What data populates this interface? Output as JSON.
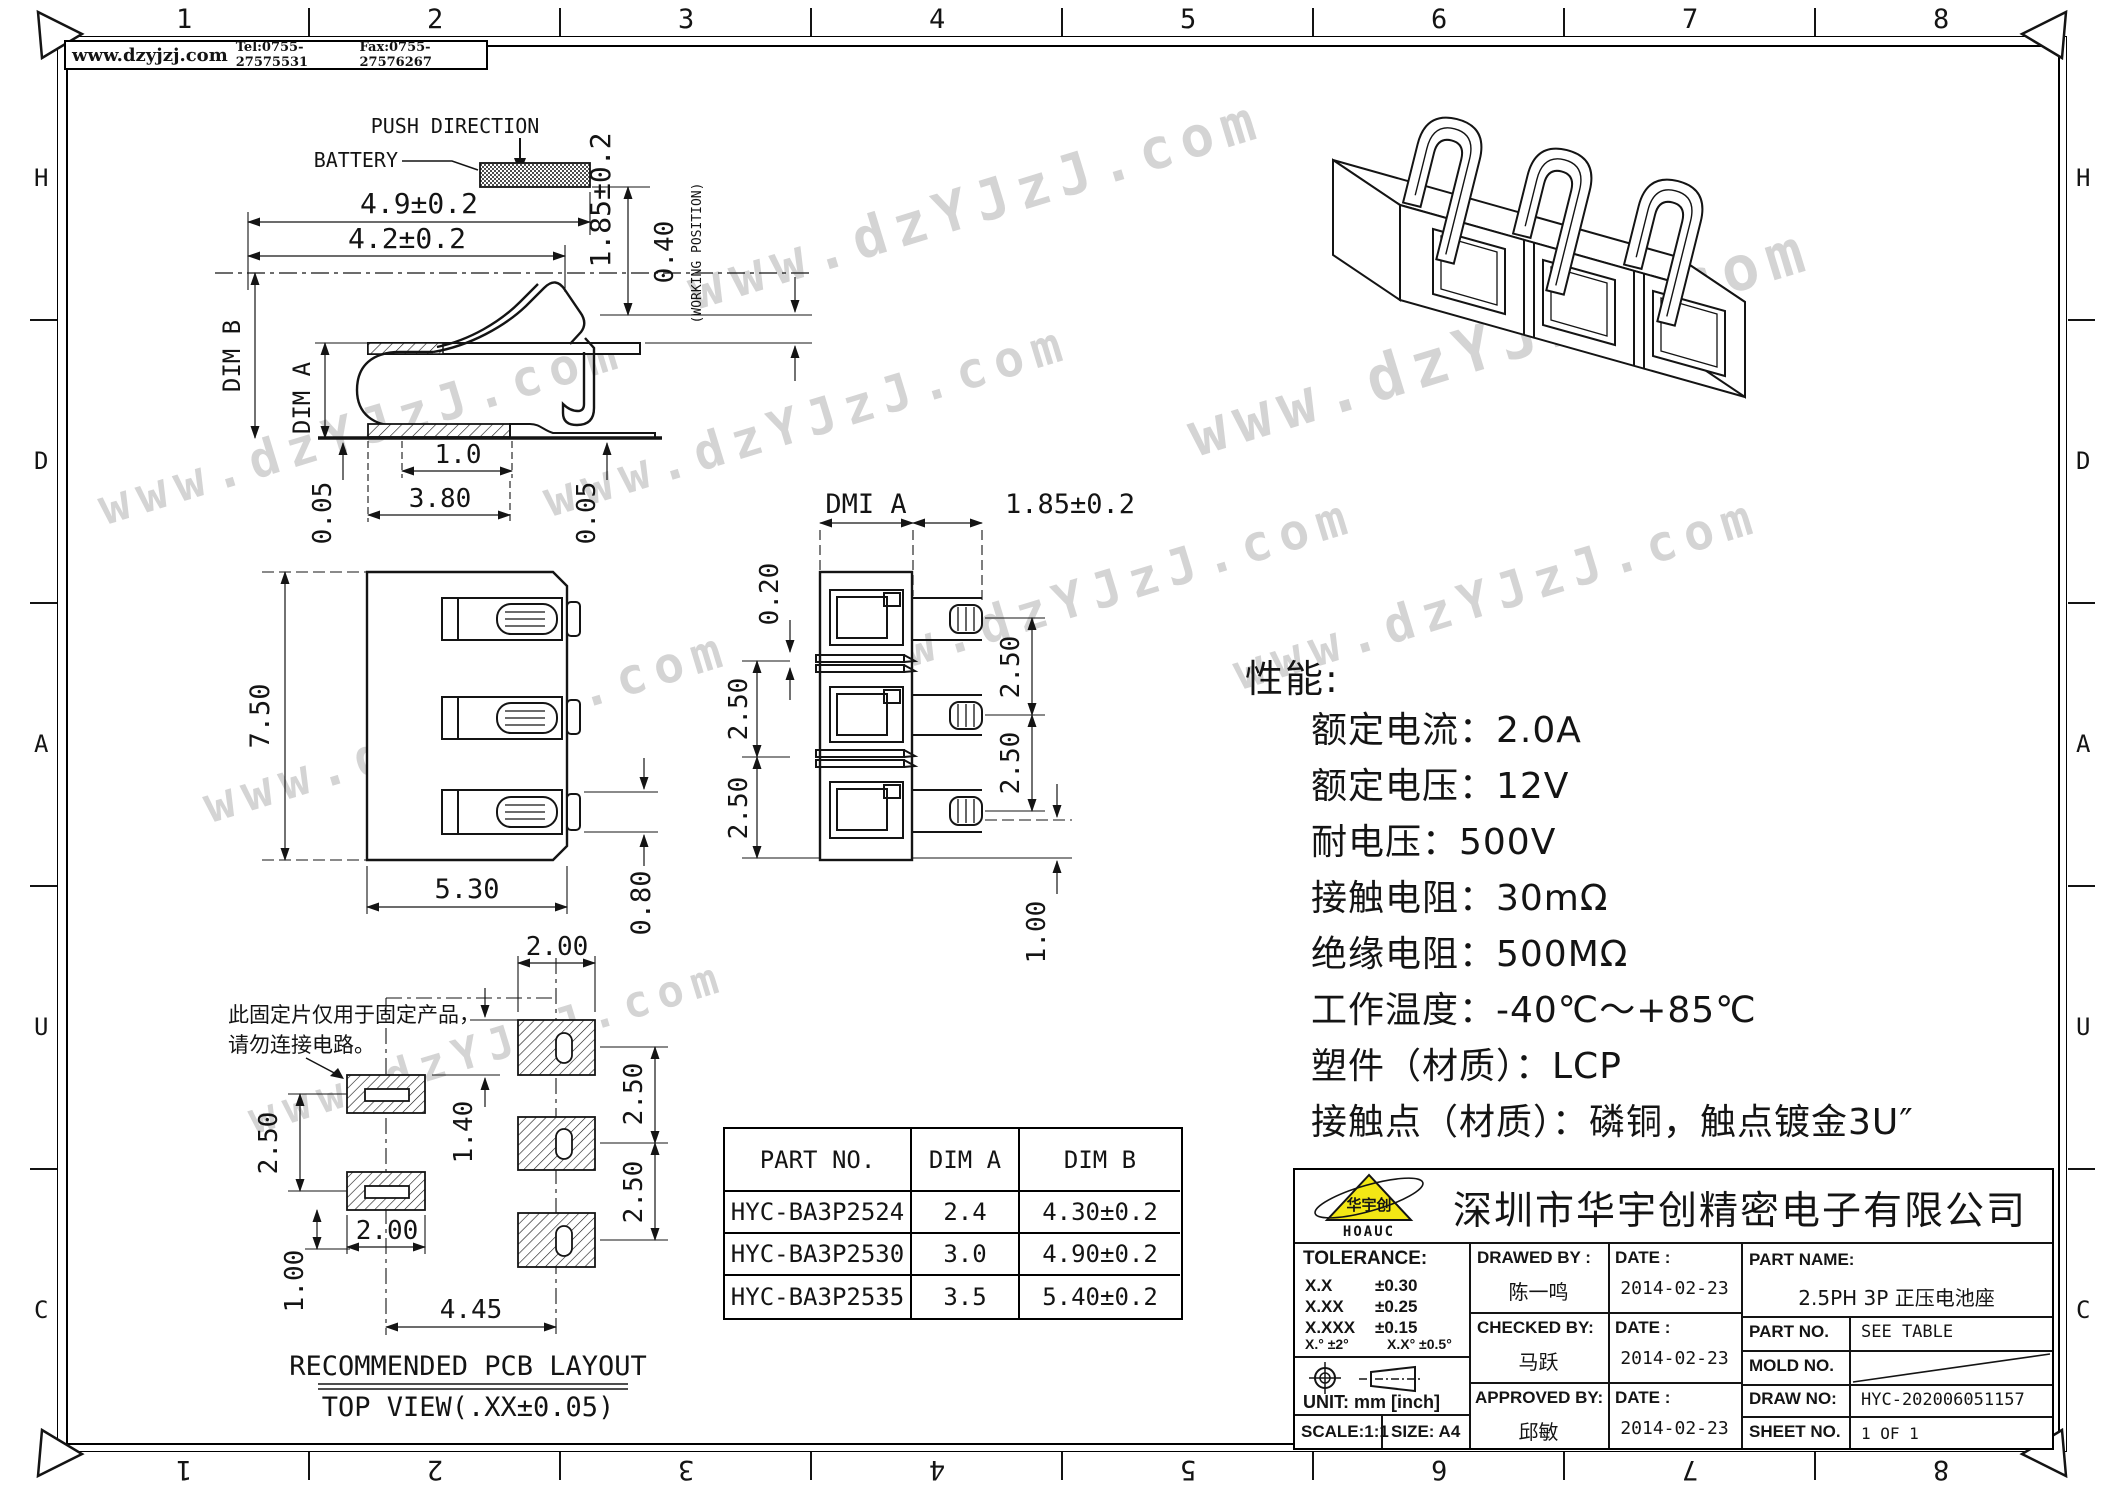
{
  "watermark": {
    "text": "www.dzYJzJ.com"
  },
  "border": {
    "top_numbers": [
      "1",
      "2",
      "3",
      "4",
      "5",
      "6",
      "7",
      "8"
    ],
    "bottom_numbers": [
      "8",
      "7",
      "6",
      "5",
      "4",
      "3",
      "2",
      "1"
    ],
    "left_letters": [
      "H",
      "D",
      "A",
      "U",
      "C"
    ],
    "right_letters": [
      "H",
      "D",
      "A",
      "U",
      "C"
    ]
  },
  "header": {
    "website": "www.dzyjzj.com",
    "tel": "Tel:0755-27575531",
    "fax": "Fax:0755-27576267"
  },
  "spring_view": {
    "push_direction": "PUSH DIRECTION",
    "battery": "BATTERY",
    "dim_w_outer": "4.9±0.2",
    "dim_w_inner": "4.2±0.2",
    "dim_height": "1.85±0.2",
    "dim_working": "0.40",
    "working_position": "(WORKING POSITION)",
    "dim_b": "DIM B",
    "dim_a": "DIM A",
    "dim_tail": "1.0",
    "dim_base": "3.80",
    "dim_left_gap": "0.05",
    "dim_right_gap": "0.05"
  },
  "front_view": {
    "dim_height": "7.50",
    "dim_width": "5.30",
    "dim_pin": "0.80"
  },
  "section_view": {
    "dim_a": "DMI A",
    "dim_pin_len": "1.85±0.2",
    "dim_gap": "0.20",
    "dim_pitch_l1": "2.50",
    "dim_pitch_l2": "2.50",
    "dim_pitch_r1": "2.50",
    "dim_pitch_r2": "2.50",
    "dim_bottom": "1.00"
  },
  "pcb_view": {
    "note_line1": "此固定片仅用于固定产品，",
    "note_line2": "请勿连接电路。",
    "dim_pad_w_top": "2.00",
    "dim_offset": "1.40",
    "dim_pitch_left": "2.50",
    "dim_pad_w_bottom": "2.00",
    "dim_pad_h": "1.00",
    "dim_span": "4.45",
    "dim_pitch_r1": "2.50",
    "dim_pitch_r2": "2.50",
    "title": "RECOMMENDED PCB LAYOUT",
    "subtitle": "TOP VIEW(.XX±0.05)"
  },
  "specs": {
    "title": "性能:",
    "items": [
      "额定电流：2.0A",
      "额定电压：12V",
      "耐电压：500V",
      "接触电阻：30mΩ",
      "绝缘电阻：500MΩ",
      "工作温度：-40℃～+85℃",
      "塑件（材质）：LCP",
      "接触点（材质）：磷铜，触点镀金3U″"
    ]
  },
  "part_table": {
    "headers": [
      "PART NO.",
      "DIM A",
      "DIM B"
    ],
    "rows": [
      [
        "HYC-BA3P2524",
        "2.4",
        "4.30±0.2"
      ],
      [
        "HYC-BA3P2530",
        "3.0",
        "4.90±0.2"
      ],
      [
        "HYC-BA3P2535",
        "3.5",
        "5.40±0.2"
      ]
    ]
  },
  "title_block": {
    "logo_text": "HOAUC",
    "logo_cn": "华宇创",
    "company": "深圳市华宇创精密电子有限公司",
    "tolerance_label": "TOLERANCE:",
    "tol_rows": [
      [
        "X.X",
        "±0.30"
      ],
      [
        "X.XX",
        "±0.25"
      ],
      [
        "X.XXX",
        "±0.15"
      ]
    ],
    "tol_angle1": "X.° ±2°",
    "tol_angle2": "X.X° ±0.5°",
    "unit": "UNIT: mm [inch]",
    "scale": "SCALE:1:1",
    "size": "SIZE: A4",
    "drawed_by": "DRAWED BY :",
    "drawed_name": "陈一鸣",
    "checked_by": "CHECKED BY:",
    "checked_name": "马跃",
    "approved_by": "APPROVED BY:",
    "approved_name": "邱敏",
    "date_label1": "DATE :",
    "date_label2": "DATE :",
    "date_label3": "DATE :",
    "date1": "2014-02-23",
    "date2": "2014-02-23",
    "date3": "2014-02-23",
    "part_name_label": "PART NAME:",
    "part_name": "2.5PH 3P 正压电池座",
    "part_no_label": "PART NO.",
    "part_no": "SEE TABLE",
    "mold_no_label": "MOLD NO.",
    "draw_no_label": "DRAW NO:",
    "draw_no": "HYC-202006051157",
    "sheet_no_label": "SHEET NO.",
    "sheet_no": "1 OF 1"
  }
}
